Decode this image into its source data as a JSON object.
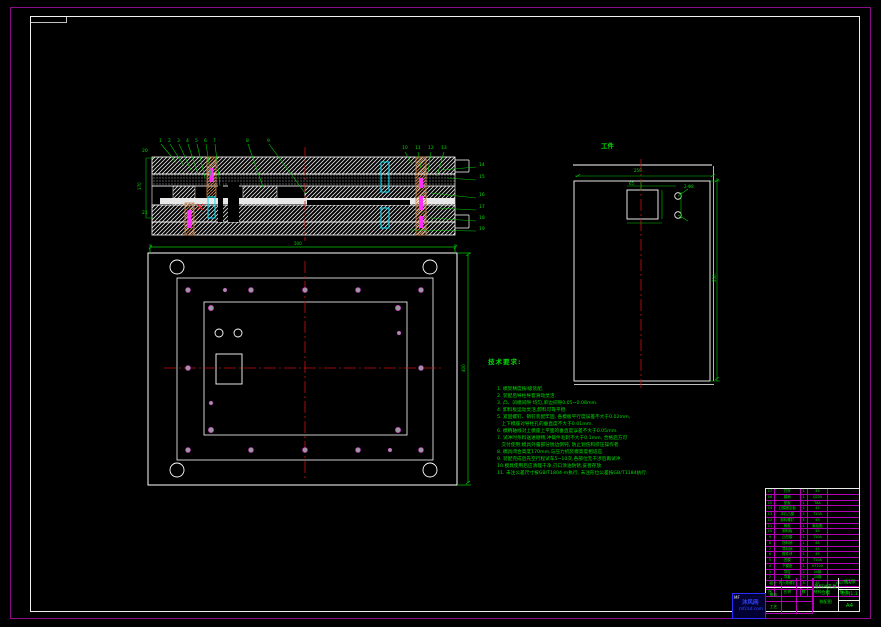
{
  "labels": {
    "workpiece": "工件",
    "notes_heading": "技术要求:"
  },
  "notes": [
    "1. 模架精度按Ⅰ级装配.",
    "2. 装配后导柱导套滑动灵活.",
    "3. 凸、凹模间隙 均匀,单边间隙0.05~0.08mm.",
    "4. 卸料板运动灵活,卸料可靠平稳.",
    "5. 紧固螺钉、销钉装配牢固, 各模板平行度误差不大于0.02mm,",
    "   上下模座对导柱孔的垂直度不大于0.01mm.",
    "6. 模柄轴线对上模座上平面的垂直度误差不大于0.05mm.",
    "7. 试冲时条料送进顺畅,冲裁件毛刺不大于0.1mm, 合格后方可",
    "   交付使用;模具外露部分锐边倒钝, 防止划伤和挤压操作者.",
    "8. 模具闭合高度170mm,与压力机装模高度相适应.",
    "9. 装配完成后先空行程试车5~10次,各部位无干涉后再试冲.",
    "10.模具使用后应清理干净,刃口涂油防锈,妥善存放.",
    "11. 未注公差尺寸按GB/T1804-m执行, 未注形位公差按GB/T1184执行."
  ],
  "item_numbers": [
    {
      "t": "1",
      "x": 159,
      "y": 139
    },
    {
      "t": "2",
      "x": 168,
      "y": 139
    },
    {
      "t": "3",
      "x": 177,
      "y": 139
    },
    {
      "t": "4",
      "x": 186,
      "y": 139
    },
    {
      "t": "5",
      "x": 195,
      "y": 139
    },
    {
      "t": "6",
      "x": 204,
      "y": 139
    },
    {
      "t": "7",
      "x": 213,
      "y": 139
    },
    {
      "t": "8",
      "x": 246,
      "y": 139
    },
    {
      "t": "9",
      "x": 267,
      "y": 139
    },
    {
      "t": "10",
      "x": 402,
      "y": 146
    },
    {
      "t": "11",
      "x": 415,
      "y": 146
    },
    {
      "t": "12",
      "x": 428,
      "y": 146
    },
    {
      "t": "13",
      "x": 441,
      "y": 146
    },
    {
      "t": "14",
      "x": 479,
      "y": 163
    },
    {
      "t": "15",
      "x": 479,
      "y": 175
    },
    {
      "t": "16",
      "x": 479,
      "y": 193
    },
    {
      "t": "17",
      "x": 479,
      "y": 205
    },
    {
      "t": "18",
      "x": 479,
      "y": 216
    },
    {
      "t": "19",
      "x": 479,
      "y": 227
    },
    {
      "t": "20",
      "x": 142,
      "y": 149
    },
    {
      "t": "21",
      "x": 142,
      "y": 211
    }
  ],
  "dim_labels": [
    {
      "t": "500",
      "x": 294,
      "y": 241
    },
    {
      "t": "400",
      "x": 461,
      "y": 372,
      "r": 1
    },
    {
      "t": "170",
      "x": 137,
      "y": 190,
      "r": 1
    },
    {
      "t": "250",
      "x": 634,
      "y": 168
    },
    {
      "t": "350",
      "x": 712,
      "y": 282,
      "r": 1
    },
    {
      "t": "65",
      "x": 629,
      "y": 181
    },
    {
      "t": "2-Φ8",
      "x": 684,
      "y": 184
    }
  ],
  "bom": {
    "columns": [
      "序号",
      "名称",
      "数量",
      "材料",
      "备注"
    ],
    "rows": [
      [
        "17",
        "打杆",
        "1",
        "45",
        ""
      ],
      [
        "16",
        "模柄",
        "1",
        "Q235",
        ""
      ],
      [
        "15",
        "垫板",
        "1",
        "T8A",
        ""
      ],
      [
        "14",
        "凸模固定板",
        "1",
        "45",
        ""
      ],
      [
        "13",
        "冲孔凸模",
        "2",
        "T10A",
        ""
      ],
      [
        "12",
        "卸料螺钉",
        "4",
        "45",
        ""
      ],
      [
        "11",
        "橡胶",
        "1",
        "聚氨酯",
        ""
      ],
      [
        "10",
        "卸料板",
        "1",
        "45",
        ""
      ],
      [
        "9",
        "凸凹模",
        "1",
        "T10A",
        ""
      ],
      [
        "8",
        "挡料销",
        "1",
        "45",
        ""
      ],
      [
        "7",
        "导料销",
        "2",
        "45",
        ""
      ],
      [
        "6",
        "推件块",
        "1",
        "45",
        ""
      ],
      [
        "5",
        "凹模",
        "1",
        "T10A",
        ""
      ],
      [
        "4",
        "下模座",
        "1",
        "HT200",
        ""
      ],
      [
        "3",
        "导柱",
        "2",
        "20钢",
        ""
      ],
      [
        "2",
        "导套",
        "2",
        "20钢",
        ""
      ],
      [
        "1",
        "内六角螺钉",
        "8",
        "45",
        "GB/T70.1"
      ]
    ]
  },
  "title_block": {
    "title": "落料冲孔复合模",
    "subtitle": "装配图",
    "sig_rows": [
      [
        "设计",
        "",
        ""
      ],
      [
        "审核",
        "",
        ""
      ],
      [
        "工艺",
        "",
        ""
      ]
    ],
    "right_cells": [
      "共1张",
      "比例1:1",
      "A4"
    ]
  },
  "stamp": {
    "mark": "MF",
    "line1": "沐风网",
    "line2": "mfcad.com"
  },
  "colors": {
    "line_green": "#00dc00",
    "frame_magenta": "#8a0d8a",
    "grid_magenta": "#b400b4",
    "centerline_red": "#cc1111",
    "detail_cyan": "#00e5ff",
    "pillar_brown": "#c8824b"
  }
}
